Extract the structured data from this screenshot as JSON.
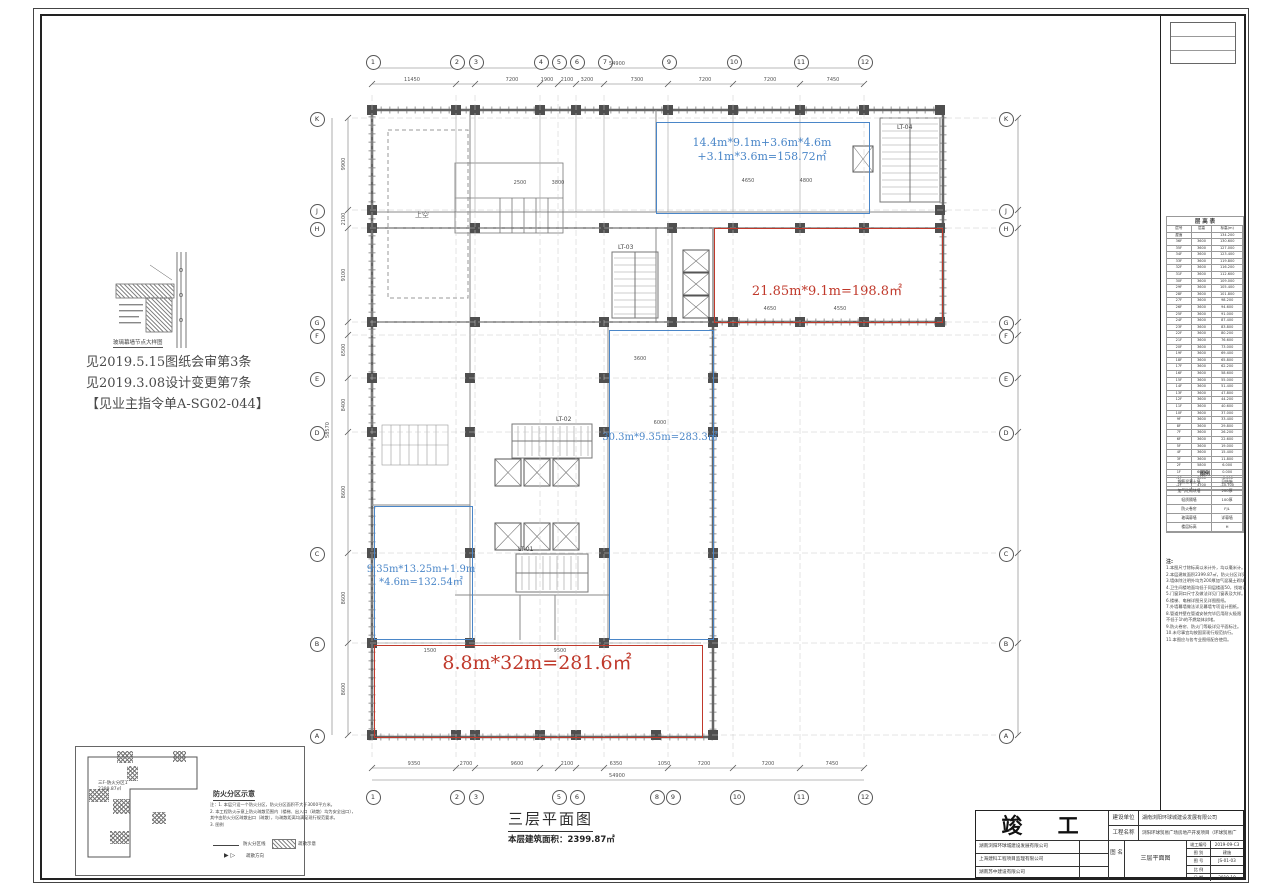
{
  "sheet": {
    "drawing_title": "三层平面图",
    "area_label": "本层建筑面积：",
    "area_value": "2399.87㎡"
  },
  "annotations": {
    "revision_notes": [
      "见2019.5.15图纸会审第3条",
      "见2019.3.08设计变更第7条",
      "【见业主指令单A-SG02-044】"
    ],
    "detail_caption": "玻璃幕墙节点大样图",
    "void_label": "上空"
  },
  "regions": [
    {
      "id": "blue-top",
      "lines": [
        "14.4m*9.1m+3.6m*4.6m",
        "+3.1m*3.6m=158.72㎡"
      ]
    },
    {
      "id": "red-top",
      "lines": [
        "21.85m*9.1m=198.8㎡"
      ]
    },
    {
      "id": "blue-mid",
      "lines": [
        "30.3m*9.35m=283.3㎡"
      ]
    },
    {
      "id": "blue-left",
      "lines": [
        "9.35m*13.25m+1.9m",
        "*4.6m=132.54㎡"
      ]
    },
    {
      "id": "red-bottom",
      "lines": [
        "8.8m*32m=281.6㎡"
      ]
    }
  ],
  "grid": {
    "top": [
      "1",
      "2",
      "3",
      "4",
      "5",
      "6",
      "7",
      "9",
      "10",
      "11",
      "12"
    ],
    "bottom": [
      "1",
      "2",
      "3",
      "5",
      "6",
      "8",
      "9",
      "10",
      "11",
      "12"
    ],
    "left": [
      "K",
      "J",
      "H",
      "G",
      "F",
      "E",
      "D",
      "C",
      "B",
      "A"
    ],
    "right": [
      "K",
      "J",
      "H",
      "G",
      "F",
      "E",
      "D",
      "C",
      "B",
      "A"
    ]
  },
  "dims": {
    "top_total": "54900",
    "top": [
      "11450",
      "7200",
      "1900",
      "2100",
      "3200",
      "7300",
      "7200",
      "7200",
      "7450"
    ],
    "bottom_total": "54900",
    "bottom": [
      "9350",
      "2700",
      "9600",
      "2100",
      "6350",
      "1050",
      "7200",
      "7200",
      "7450"
    ],
    "left": [
      "9900",
      "2100",
      "9100",
      "6500",
      "8400",
      "8600",
      "8600",
      "8600"
    ],
    "left_total": "58570"
  },
  "plan_dims": [
    "4650",
    "4800",
    "2500",
    "3800",
    "4650",
    "4550",
    "3600",
    "9500",
    "1500",
    "6000"
  ],
  "cores": {
    "stairs": [
      "LT-01",
      "LT-02",
      "LT-03",
      "LT-04"
    ]
  },
  "fire": {
    "heading": "防火分区示意",
    "zone_label": "三F-防火分区1",
    "zone_area": "2399.87㎡",
    "notes": [
      "注：1. 本层只设一个防火分区，防火分区面积不大于3000平方米。",
      "2. 本工程防火示意上防火疏散范围内（楼梯、出入口（疏散）均为安全出口），",
      "其中由防火分区疏散出口（疏散），与疏散距离均满足现行规范要求。",
      "3. 图例"
    ],
    "legend_line": "防火分区线",
    "legend_hatch": "疏散示意",
    "legend_dir": "疏散方向"
  },
  "floor_table": {
    "title": "层 高 表",
    "headers": [
      "层号",
      "层高",
      "标高(m)"
    ],
    "rows": [
      [
        "屋面",
        "",
        "134.200"
      ],
      [
        "36F",
        "3600",
        "130.600"
      ],
      [
        "35F",
        "3600",
        "127.000"
      ],
      [
        "34F",
        "3600",
        "123.400"
      ],
      [
        "33F",
        "3600",
        "119.800"
      ],
      [
        "32F",
        "3600",
        "116.200"
      ],
      [
        "31F",
        "3600",
        "112.600"
      ],
      [
        "30F",
        "3600",
        "109.000"
      ],
      [
        "29F",
        "3600",
        "105.400"
      ],
      [
        "28F",
        "3600",
        "101.800"
      ],
      [
        "27F",
        "3600",
        "98.200"
      ],
      [
        "26F",
        "3600",
        "94.600"
      ],
      [
        "25F",
        "3600",
        "91.000"
      ],
      [
        "24F",
        "3600",
        "87.400"
      ],
      [
        "23F",
        "3600",
        "83.800"
      ],
      [
        "22F",
        "3600",
        "80.200"
      ],
      [
        "21F",
        "3600",
        "76.600"
      ],
      [
        "20F",
        "3600",
        "73.000"
      ],
      [
        "19F",
        "3600",
        "69.400"
      ],
      [
        "18F",
        "3600",
        "65.800"
      ],
      [
        "17F",
        "3600",
        "62.200"
      ],
      [
        "16F",
        "3600",
        "58.600"
      ],
      [
        "15F",
        "3600",
        "55.000"
      ],
      [
        "14F",
        "3600",
        "51.400"
      ],
      [
        "13F",
        "3600",
        "47.800"
      ],
      [
        "12F",
        "3600",
        "44.200"
      ],
      [
        "11F",
        "3600",
        "40.600"
      ],
      [
        "10F",
        "3600",
        "37.000"
      ],
      [
        "9F",
        "3600",
        "33.400"
      ],
      [
        "8F",
        "3600",
        "29.800"
      ],
      [
        "7F",
        "3600",
        "26.200"
      ],
      [
        "6F",
        "3600",
        "22.600"
      ],
      [
        "5F",
        "3600",
        "19.000"
      ],
      [
        "4F",
        "3600",
        "15.400"
      ],
      [
        "3F",
        "3600",
        "11.800"
      ],
      [
        "2F",
        "5800",
        "6.000"
      ],
      [
        "1F",
        "6000",
        "0.000"
      ],
      [
        "-1F",
        "6000",
        "-6.000"
      ],
      [
        "-2F",
        "4700",
        "-10.700"
      ]
    ]
  },
  "wall_legend": {
    "title": "图例",
    "rows": [
      [
        "钢筋混凝土墙",
        "见结施"
      ],
      [
        "加气砼砌块墙",
        "200厚"
      ],
      [
        "轻质隔墙",
        "100厚"
      ],
      [
        "防火卷帘",
        "FJL"
      ],
      [
        "玻璃幕墙",
        "详幕墙"
      ],
      [
        "楼层标高",
        "H"
      ]
    ]
  },
  "right_notes": {
    "heading": "注:",
    "lines": [
      "1.本图尺寸除标高以米计外，均以毫米计。",
      "2.本层建筑面积2399.87㎡，防火分区详见示意。",
      "3.墙体除注明外均为200厚加气混凝土砌块墙。",
      "4.卫生间楼地面均低于同层楼面50，找坡详水施。",
      "5.门窗洞口尺寸及做法详见门窗表及大样。",
      "6.楼梯、电梯详图另见详图图纸。",
      "7.外墙幕墙做法详见幕墙专项设计图纸。",
      "8.管道井壁在管道安装完毕后用耐火极限",
      "不低于1h的不燃烧体封堵。",
      "9.防火卷帘、防火门等级详见平面标注。",
      "10.未尽事宜均按国家现行规范执行。",
      "11.本图应与各专业图纸配合使用。"
    ]
  },
  "stamp": {
    "title": "竣 工 图",
    "companies": [
      "湖南浏阳环球城建设发展有限公司",
      "上海建科工程项目监理有限公司",
      "湖南苏中建设有限公司"
    ],
    "owner_label": "建设单位",
    "owner": "湖南浏阳环球城建设发展有限公司",
    "project_label": "工程名称",
    "project": "浏阳环球贸易广场房地产开发项目（环球贸易广场）",
    "dwgname_label": "图 名",
    "dwgname": "三层平面图",
    "rows": [
      [
        "竣工编号",
        "2019-09-C3"
      ],
      [
        "图 别",
        "建施"
      ],
      [
        "图 号",
        "JS-01-03"
      ],
      [
        "比 例",
        ""
      ],
      [
        "日 期",
        "2019-10"
      ]
    ]
  }
}
